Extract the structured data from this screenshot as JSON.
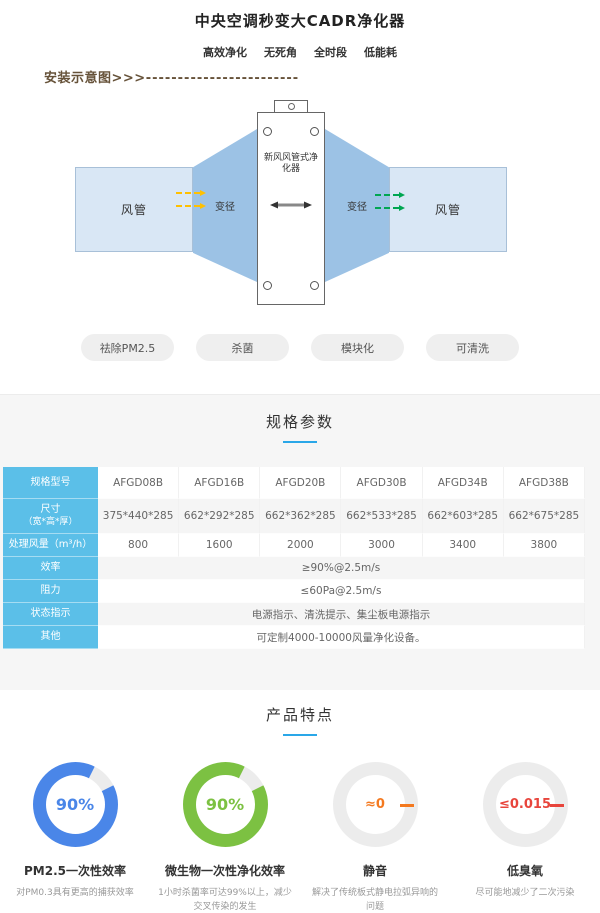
{
  "header": {
    "title": "中央空调秒变大CADR净化器",
    "features": [
      "高效净化",
      "无死角",
      "全时段",
      "低能耗"
    ]
  },
  "install": {
    "label": "安装示意图>>>",
    "dashes": "------------------------",
    "duct_left": "风管",
    "reducer_left": "变径",
    "device_label": "新风风管式净化器",
    "reducer_right": "变径",
    "duct_right": "风管"
  },
  "tags": [
    "祛除PM2.5",
    "杀菌",
    "模块化",
    "可清洗"
  ],
  "specs": {
    "title": "规格参数",
    "rows": {
      "model": {
        "label": "规格型号",
        "values": [
          "AFGD08B",
          "AFGD16B",
          "AFGD20B",
          "AFGD30B",
          "AFGD34B",
          "AFGD38B"
        ]
      },
      "size": {
        "label": "尺寸",
        "sublabel": "（宽*高*厚）",
        "values": [
          "375*440*285",
          "662*292*285",
          "662*362*285",
          "662*533*285",
          "662*603*285",
          "662*675*285"
        ]
      },
      "airflow": {
        "label": "处理风量（m³/h）",
        "values": [
          "800",
          "1600",
          "2000",
          "3000",
          "3400",
          "3800"
        ]
      },
      "efficiency": {
        "label": "效率",
        "value": "≥90%@2.5m/s"
      },
      "resistance": {
        "label": "阻力",
        "value": "≤60Pa@2.5m/s"
      },
      "status": {
        "label": "状态指示",
        "value": "电源指示、清洗提示、集尘板电源指示"
      },
      "other": {
        "label": "其他",
        "value": "可定制4000-10000风量净化设备。"
      }
    }
  },
  "features_section": {
    "title": "产品特点",
    "items": [
      {
        "value": "90%",
        "percent": 90,
        "ring": "#4a86e8",
        "value_color": "#4a86e8",
        "label": "PM2.5一次性效率",
        "desc": "对PM0.3具有更高的捕获效率"
      },
      {
        "value": "90%",
        "percent": 90,
        "ring": "#7cc142",
        "value_color": "#7cc142",
        "label": "微生物一次性净化效率",
        "desc": "1小时杀菌率可达99%以上，减少交叉传染的发生"
      },
      {
        "value": "≈0",
        "percent": 0,
        "ring": "#ececec",
        "value_color": "#f4791f",
        "label": "静音",
        "desc": "解决了传统板式静电拉弧异响的问题"
      },
      {
        "value": "≤0.015",
        "percent": 0,
        "ring": "#ececec",
        "value_color": "#e8453c",
        "label": "低臭氧",
        "desc": "尽可能地减少了二次污染"
      }
    ]
  },
  "colors": {
    "accent_underline": "#2aa7e8",
    "table_header_bg": "#5bbfe8",
    "install_label": "#665239",
    "duct_fill": "#d9e7f5",
    "reducer_fill": "#9cc2e5",
    "arrow_in_yellow": "#ffc000",
    "arrow_out_green": "#00a651"
  }
}
